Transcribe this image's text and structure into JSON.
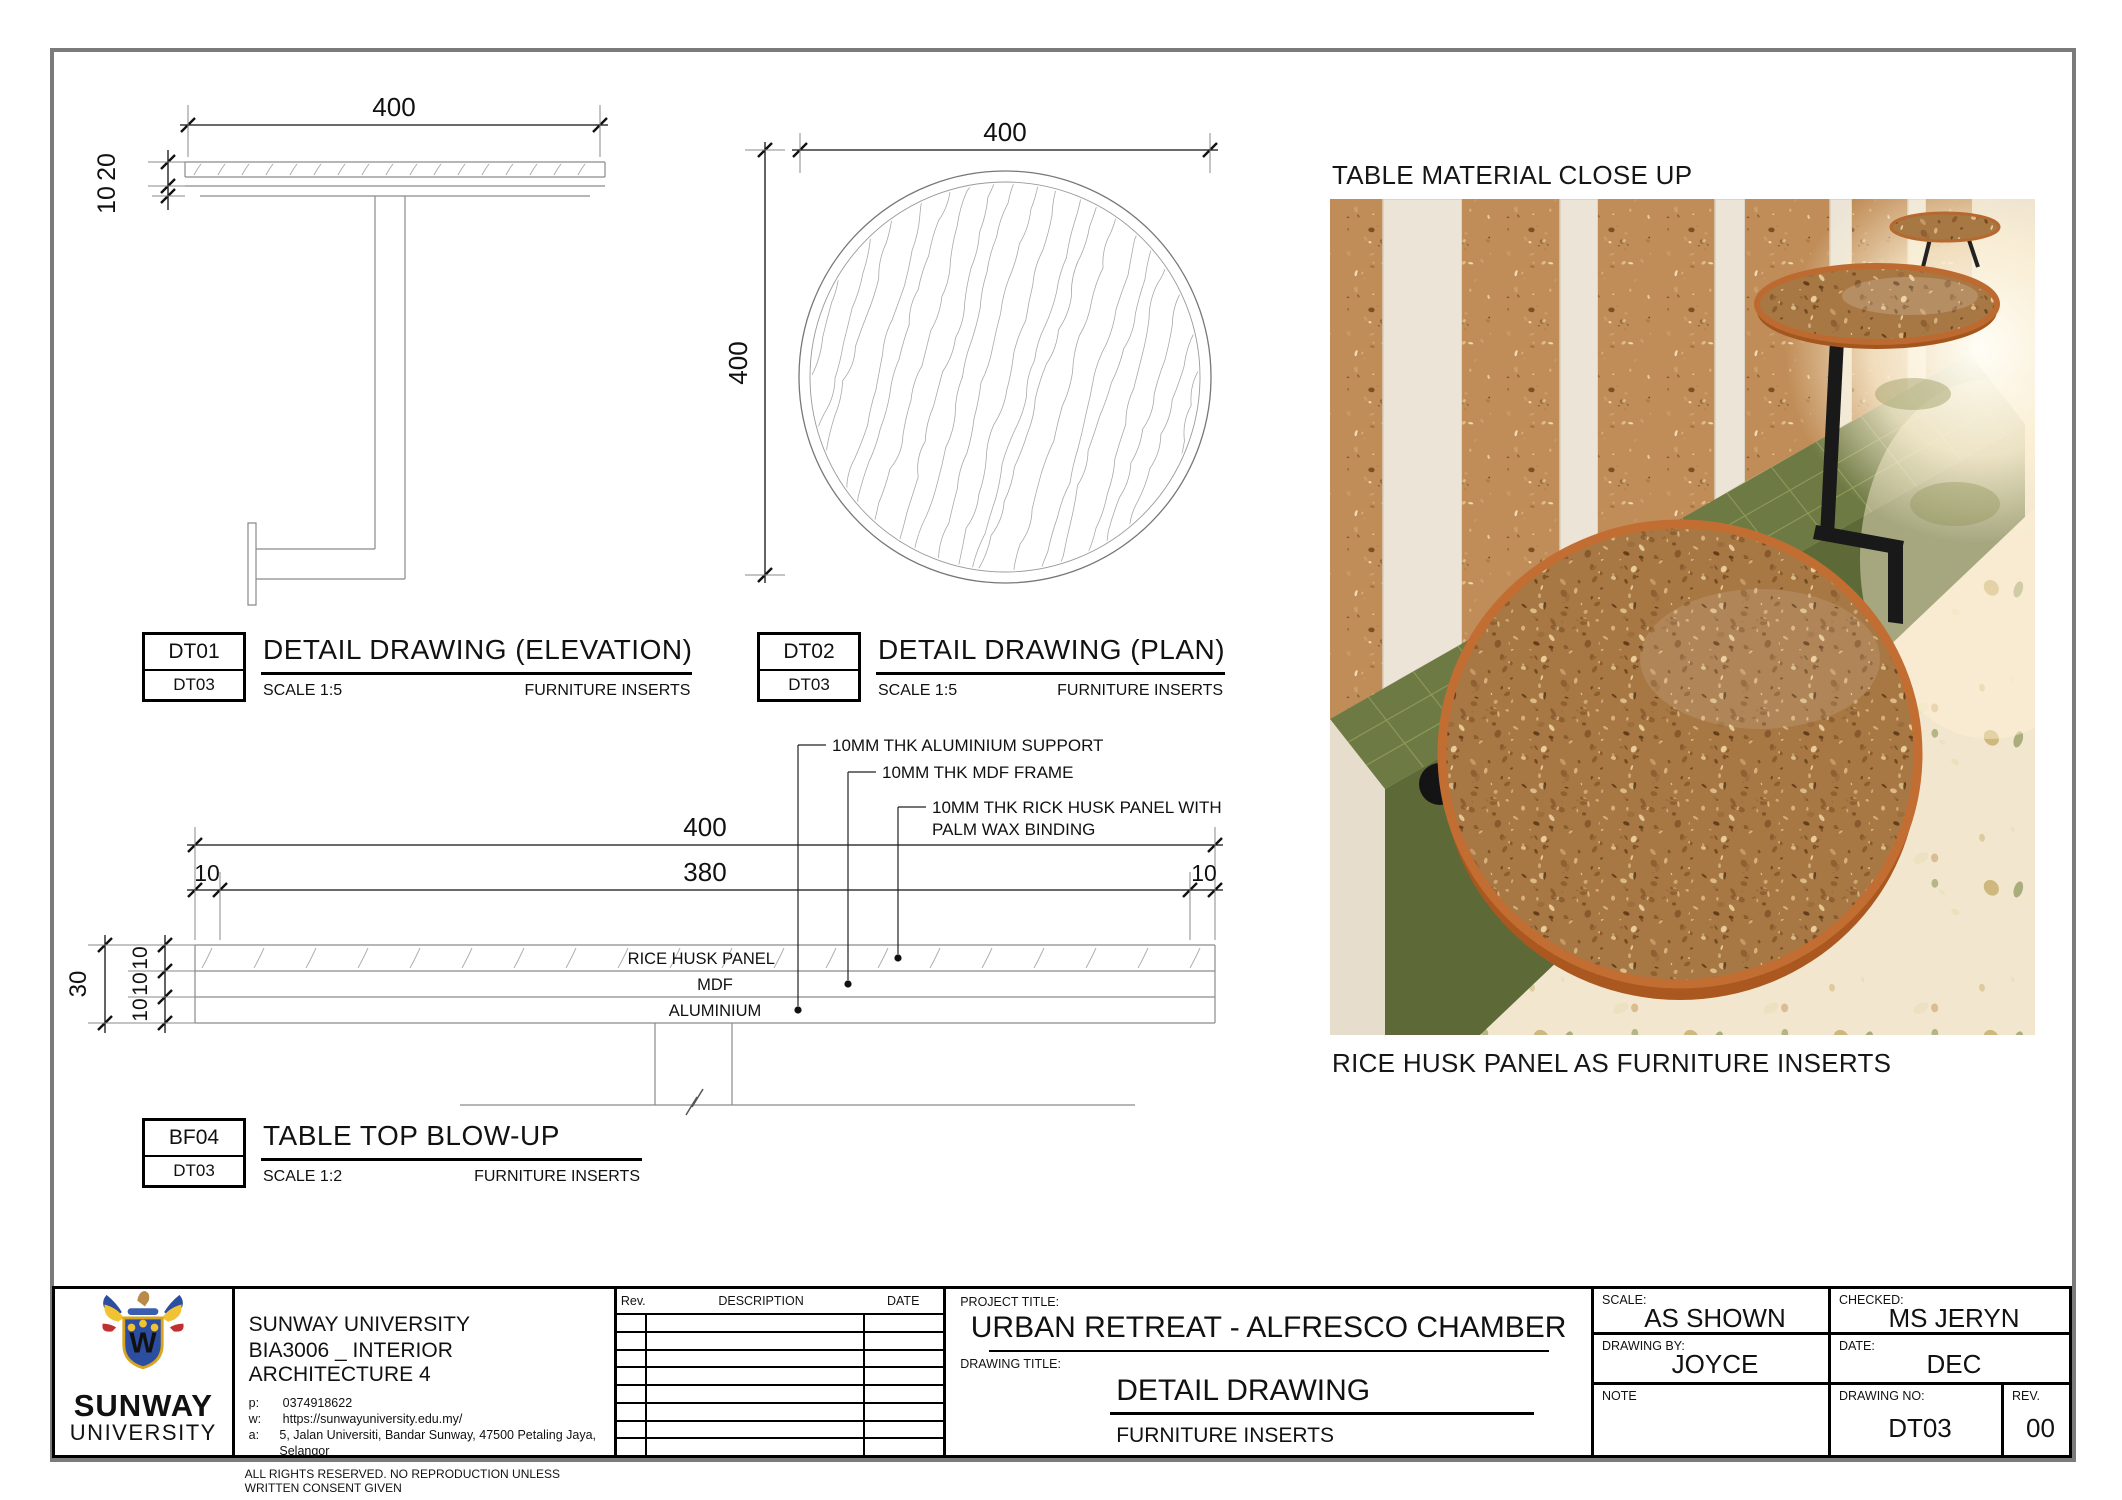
{
  "views": {
    "elevation": {
      "code": "DT01",
      "ref": "DT03",
      "title": "DETAIL DRAWING (ELEVATION)",
      "scale": "SCALE 1:5",
      "subtitle": "FURNITURE INSERTS",
      "dim_width": "400",
      "dim_thickness_top": "20",
      "dim_thickness_bottom": "10"
    },
    "plan": {
      "code": "DT02",
      "ref": "DT03",
      "title": "DETAIL DRAWING (PLAN)",
      "scale": "SCALE 1:5",
      "subtitle": "FURNITURE INSERTS",
      "dim_width": "400",
      "dim_height": "400"
    },
    "blowup": {
      "code": "BF04",
      "ref": "DT03",
      "title": "TABLE TOP BLOW-UP",
      "scale": "SCALE 1:2",
      "subtitle": "FURNITURE INSERTS",
      "dim_total": "400",
      "dim_left": "10",
      "dim_center": "380",
      "dim_right": "10",
      "dim_depth": "30",
      "dim_layers": [
        "10",
        "10",
        "10"
      ],
      "layers": [
        "RICE HUSK PANEL",
        "MDF",
        "ALUMINIUM"
      ],
      "callouts": [
        "10MM THK ALUMINIUM SUPPORT",
        "10MM THK MDF FRAME",
        [
          "10MM THK RICK HUSK PANEL WITH",
          "PALM WAX BINDING"
        ]
      ]
    }
  },
  "photo": {
    "heading": "TABLE MATERIAL CLOSE UP",
    "caption": "RICE HUSK PANEL AS FURNITURE INSERTS"
  },
  "title_block": {
    "logo": {
      "line1": "SUNWAY",
      "line2": "UNIVERSITY"
    },
    "university": "SUNWAY UNIVERSITY",
    "course": "BIA3006 _ INTERIOR ARCHITECTURE 4",
    "phone_label": "p:",
    "phone": "0374918622",
    "web_label": "w:",
    "web": "https://sunwayuniversity.edu.my/",
    "address_label": "a:",
    "address": "5, Jalan Universiti, Bandar Sunway, 47500 Petaling Jaya, Selangor",
    "rights": "ALL RIGHTS RESERVED. NO REPRODUCTION UNLESS WRITTEN CONSENT GIVEN",
    "rev_table": {
      "headers": [
        "Rev.",
        "DESCRIPTION",
        "DATE"
      ]
    },
    "project_title_label": "PROJECT TITLE:",
    "project_title": "URBAN RETREAT - ALFRESCO CHAMBER",
    "drawing_title_label": "DRAWING TITLE:",
    "drawing_title": "DETAIL DRAWING",
    "drawing_subtitle": "FURNITURE INSERTS",
    "scale_label": "SCALE:",
    "scale": "AS SHOWN",
    "checked_label": "CHECKED:",
    "checked": "MS  JERYN",
    "drawn_label": "DRAWING BY:",
    "drawn": "JOYCE",
    "date_label": "DATE:",
    "date": "DEC",
    "note_label": "NOTE",
    "drawing_no_label": "DRAWING NO:",
    "drawing_no": "DT03",
    "rev_label": "REV.",
    "rev": "00"
  },
  "colors": {
    "table_rim": "#c26d32",
    "rice_husk": "#b9854f",
    "bench_green": "#6e7a44",
    "terrazzo": "#f3e6ce",
    "drawing_line": "#8a8a8a"
  }
}
